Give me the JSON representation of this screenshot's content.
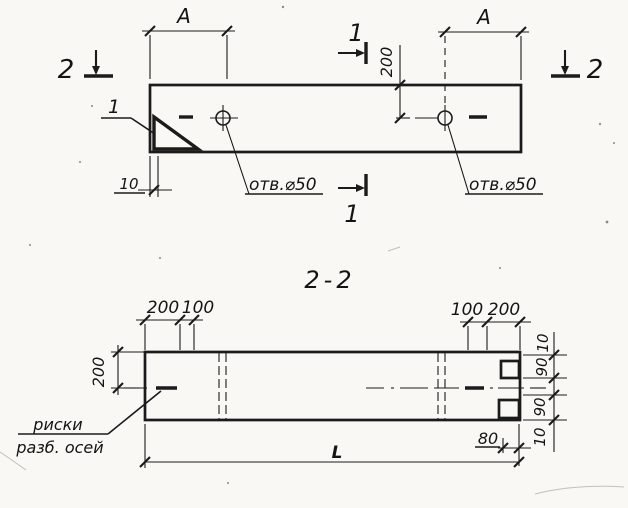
{
  "top_view": {
    "section_marker_2_left": "2",
    "section_marker_2_right": "2",
    "section_marker_1_top": "1",
    "section_marker_1_bottom": "1",
    "detail_callout": "1",
    "dim_a_left": "A",
    "dim_a_right": "A",
    "dim_200": "200",
    "dim_10": "10",
    "hole_label_left": "отв.⌀50",
    "hole_label_right": "отв.⌀50"
  },
  "section_view": {
    "title": "2-2",
    "dim_200_top_left": "200",
    "dim_100_top_left": "100",
    "dim_100_top_right": "100",
    "dim_200_top_right": "200",
    "dim_200_left": "200",
    "dim_10_right_top": "10",
    "dim_90_right_top": "90",
    "dim_90_right_bottom": "90",
    "dim_10_right_bottom": "10",
    "dim_80": "80",
    "dim_length": "L",
    "axes_note_line1": "риски",
    "axes_note_line2": "разб. осей"
  },
  "colors": {
    "ink": "#1b1b1b",
    "paper": "#f9f8f4"
  }
}
